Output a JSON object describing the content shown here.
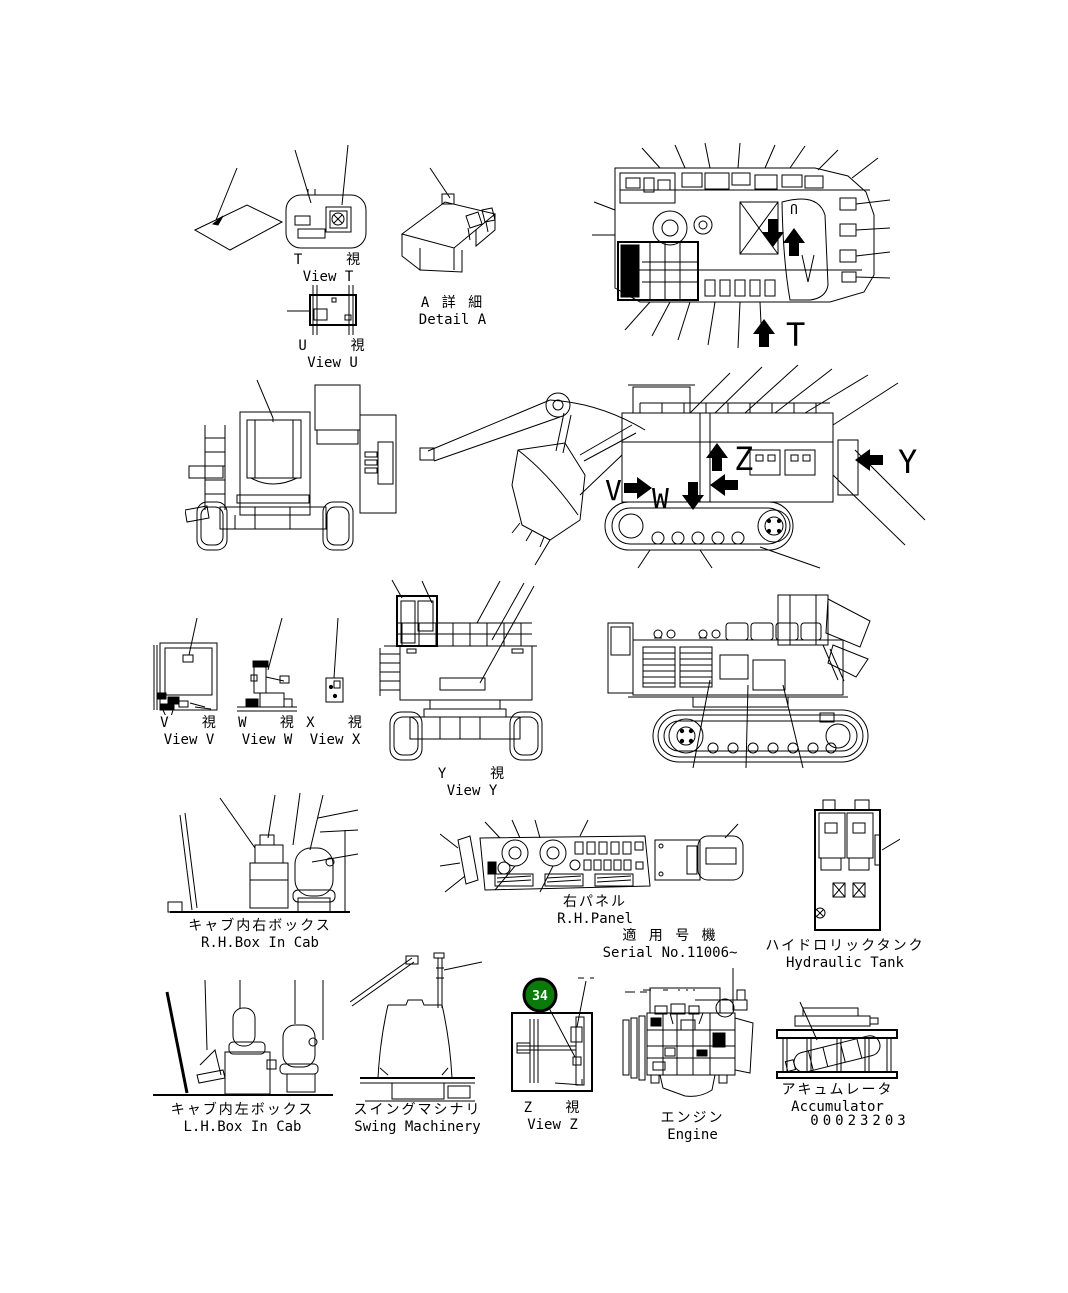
{
  "page": {
    "background": "#ffffff",
    "ink": "#000000"
  },
  "figures": {
    "view_t": {
      "title_ja": "T    視",
      "title_en": "View T"
    },
    "view_u": {
      "title_ja": "U    視",
      "title_en": "View U"
    },
    "detail_a": {
      "title_ja": "A 詳 細",
      "title_en": "Detail A"
    },
    "view_v": {
      "title_ja": "V   視",
      "title_en": "View V"
    },
    "view_w": {
      "title_ja": "W   視",
      "title_en": "View W"
    },
    "view_x": {
      "title_ja": "X   視",
      "title_en": "View X"
    },
    "view_y": {
      "title_ja": "Y    視",
      "title_en": "View Y"
    },
    "view_z": {
      "title_ja": "Z   視",
      "title_en": "View Z"
    },
    "rh_box_in_cab": {
      "title_ja": "キャブ内右ボックス",
      "title_en": "R.H.Box In Cab"
    },
    "rh_panel": {
      "title_ja": "右パネル",
      "title_en": "R.H.Panel"
    },
    "hydraulic_tank": {
      "title_ja": "ハイドロリックタンク",
      "title_en": "Hydraulic Tank"
    },
    "lh_box_in_cab": {
      "title_ja": "キャブ内左ボックス",
      "title_en": "L.H.Box In Cab"
    },
    "swing_machinery": {
      "title_ja": "スイングマシナリ",
      "title_en": "Swing Machinery"
    },
    "engine": {
      "title_ja": "エンジン",
      "title_en": "Engine"
    },
    "accumulator": {
      "title_ja": "アキュムレータ",
      "title_en": "Accumulator"
    }
  },
  "serial_note": {
    "ja": "適 用 号 機",
    "en": "Serial No.11006~"
  },
  "drawing_number": "00023203",
  "view_arrows": {
    "t": "T",
    "u": "U",
    "v": "V",
    "w": "W",
    "y": "Y",
    "z": "Z"
  },
  "balloon": {
    "number": "34",
    "fill": "#0a7a0a",
    "ring": "#000000",
    "text_color": "#ffffff"
  }
}
